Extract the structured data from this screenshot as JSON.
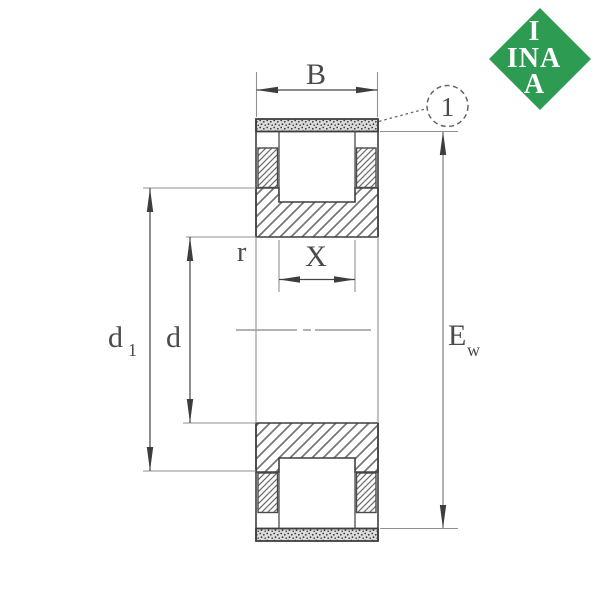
{
  "title": "INA cylindrical roller bearing dimension drawing",
  "logo": {
    "brand": "INA",
    "letter_top": "I",
    "letter_row": "INA",
    "letter_bottom": "A",
    "diamond_color": "#2E9B52",
    "letter_color": "#FFFFFF"
  },
  "diagram": {
    "kind": "bearing-cross-section",
    "dimension_labels": {
      "b": "B",
      "x": "X",
      "r": "r",
      "d": "d",
      "d1_base": "d",
      "d1_sub": "1",
      "ew_base": "E",
      "ew_sub": "w"
    },
    "callout": {
      "number": "1"
    },
    "colors": {
      "outline": "#3f3f3f",
      "hatch": "#757575",
      "extension_line": "#909090",
      "label": "#4a4a4a",
      "stipple_background": "#dcdcdc"
    }
  }
}
